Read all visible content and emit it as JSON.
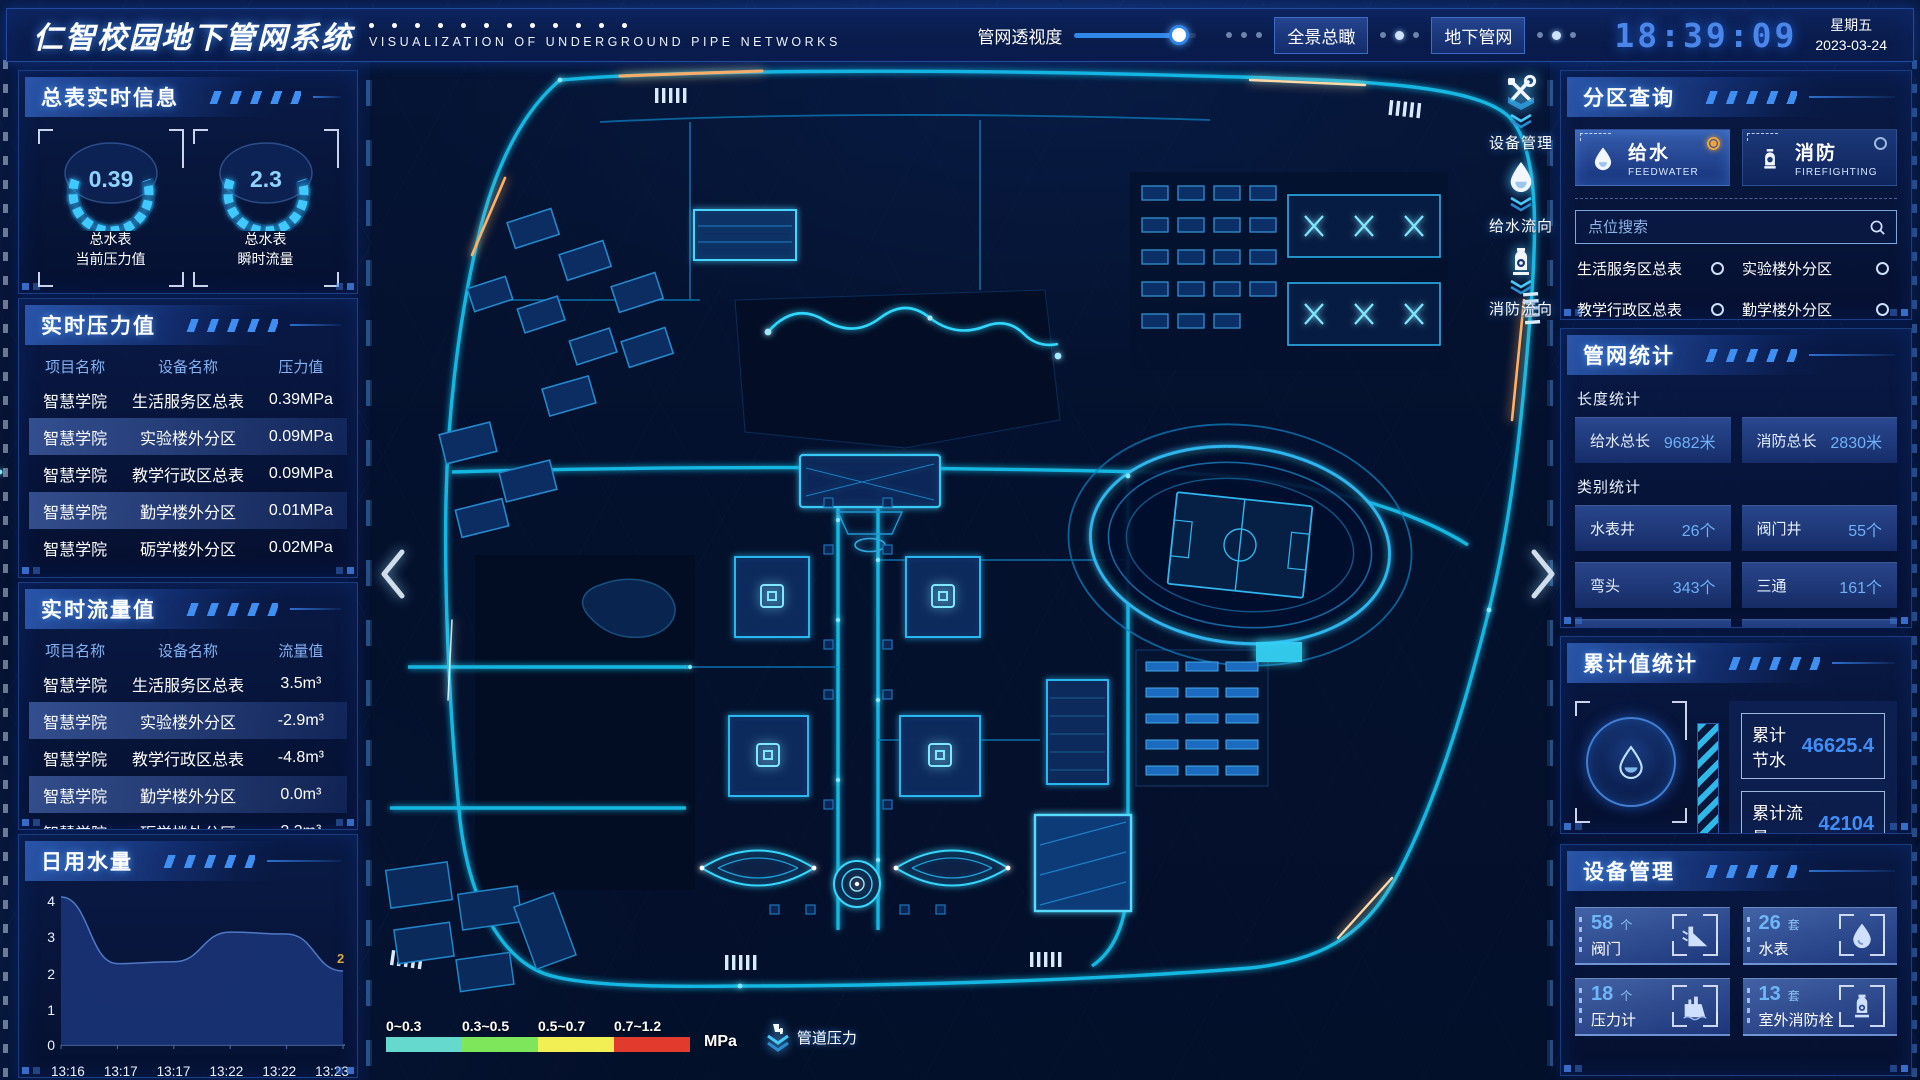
{
  "header": {
    "title": "仁智校园地下管网系统",
    "subtitle": "VISUALIZATION OF UNDERGROUND PIPE NETWORKS",
    "slider_label": "管网透视度",
    "slider_value_pct": 86,
    "buttons": [
      {
        "label": "全景总瞰"
      },
      {
        "label": "地下管网"
      }
    ],
    "clock": {
      "time": "18:39:09",
      "weekday": "星期五",
      "date": "2023-03-24"
    }
  },
  "left": {
    "realtime_info": {
      "title": "总表实时信息",
      "gauges": [
        {
          "value": "0.39",
          "line1": "总水表",
          "line2": "当前压力值"
        },
        {
          "value": "2.3",
          "line1": "总水表",
          "line2": "瞬时流量"
        }
      ]
    },
    "pressure_table": {
      "title": "实时压力值",
      "headers": [
        "项目名称",
        "设备名称",
        "压力值"
      ],
      "rows": [
        [
          "智慧学院",
          "生活服务区总表",
          "0.39MPa"
        ],
        [
          "智慧学院",
          "实验楼外分区",
          "0.09MPa"
        ],
        [
          "智慧学院",
          "教学行政区总表",
          "0.09MPa"
        ],
        [
          "智慧学院",
          "勤学楼外分区",
          "0.01MPa"
        ],
        [
          "智慧学院",
          "砺学楼外分区",
          "0.02MPa"
        ]
      ]
    },
    "flow_table": {
      "title": "实时流量值",
      "headers": [
        "项目名称",
        "设备名称",
        "流量值"
      ],
      "rows": [
        [
          "智慧学院",
          "生活服务区总表",
          "3.5m³"
        ],
        [
          "智慧学院",
          "实验楼外分区",
          "-2.9m³"
        ],
        [
          "智慧学院",
          "教学行政区总表",
          "-4.8m³"
        ],
        [
          "智慧学院",
          "勤学楼外分区",
          "0.0m³"
        ],
        [
          "智慧学院",
          "砺学楼外分区",
          "2.3m³"
        ]
      ]
    },
    "daily_water_title": "日用水量"
  },
  "chart_data": {
    "type": "area",
    "title": "日用水量",
    "x": [
      "13:16",
      "13:17",
      "13:17",
      "13:22",
      "13:22",
      "13:23"
    ],
    "values": [
      4,
      2.2,
      2.25,
      3.05,
      3.0,
      2.0
    ],
    "end_label": "2",
    "ylim": [
      0,
      4
    ],
    "yticks": [
      0,
      1,
      2,
      3,
      4
    ],
    "grid": false,
    "area_color": "#16336e",
    "line_color": "#3c6cb4"
  },
  "right": {
    "zone_query": {
      "title": "分区查询",
      "tabs": [
        {
          "label": "给水",
          "sub": "FEEDWATER",
          "icon": "water-drop-icon",
          "selected": true
        },
        {
          "label": "消防",
          "sub": "FIREFIGHTING",
          "icon": "hydrant-icon",
          "selected": false
        }
      ],
      "search_placeholder": "点位搜索",
      "search_icon": "search-icon",
      "options": [
        "生活服务区总表",
        "实验楼外分区",
        "教学行政区总表",
        "勤学楼外分区",
        "砺学楼外分区",
        "宿舍区泵房"
      ]
    },
    "pipe_stats": {
      "title": "管网统计",
      "length_title": "长度统计",
      "length_items": [
        {
          "label": "给水总长",
          "value": "9682米"
        },
        {
          "label": "消防总长",
          "value": "2830米"
        }
      ],
      "category_title": "类别统计",
      "category_items": [
        {
          "label": "水表井",
          "value": "26个"
        },
        {
          "label": "阀门井",
          "value": "55个"
        },
        {
          "label": "弯头",
          "value": "343个"
        },
        {
          "label": "三通",
          "value": "161个"
        }
      ]
    },
    "accumulated": {
      "title": "累计值统计",
      "emblem_icon": "water-drop-icon",
      "items": [
        {
          "label": "累计节水",
          "value": "46625.4"
        },
        {
          "label": "累计流量",
          "value": "42104"
        }
      ]
    },
    "devices": {
      "title": "设备管理",
      "items": [
        {
          "count": "58",
          "unit": "个",
          "label": "阀门",
          "icon": "valve-icon"
        },
        {
          "count": "26",
          "unit": "套",
          "label": "水表",
          "icon": "water-meter-icon"
        },
        {
          "count": "18",
          "unit": "个",
          "label": "压力计",
          "icon": "pressure-gauge-icon"
        },
        {
          "count": "13",
          "unit": "套",
          "label": "室外消防栓",
          "icon": "outdoor-hydrant-icon"
        }
      ]
    }
  },
  "map": {
    "tools": [
      {
        "label": "设备管理",
        "icon": "tools-icon"
      },
      {
        "label": "给水流向",
        "icon": "water-drop-icon"
      },
      {
        "label": "消防流向",
        "icon": "hydrant-icon"
      }
    ],
    "legend": {
      "ranges": [
        "0~0.3",
        "0.3~0.5",
        "0.5~0.7",
        "0.7~1.2"
      ],
      "colors": [
        "#66d9cf",
        "#7de65a",
        "#f2ef55",
        "#e23b2e"
      ],
      "unit": "MPa",
      "label": "管道压力",
      "label_icon": "pipe-pressure-icon"
    }
  },
  "colors": {
    "accent_cyan": "#2fd0f5",
    "value_blue": "#5aa8f8",
    "selected_orange": "#f0a43c",
    "panel_border": "#2e60ba",
    "clock_blue": "#4b87ea"
  }
}
